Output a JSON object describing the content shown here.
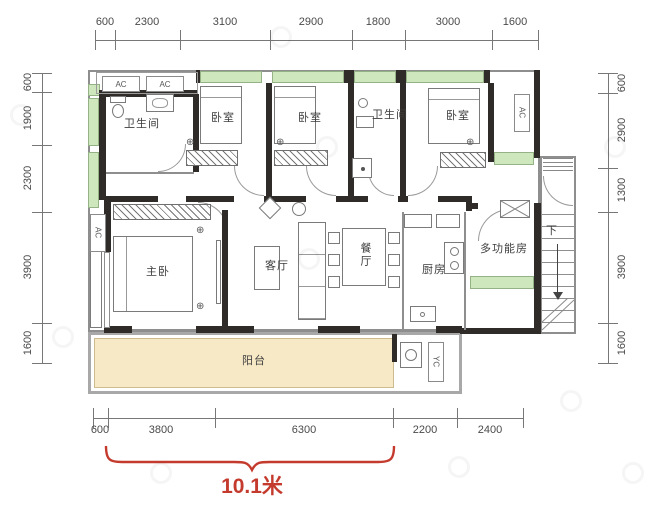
{
  "dims": {
    "top": [
      "600",
      "2300",
      "3100",
      "2900",
      "1800",
      "3000",
      "1600"
    ],
    "left": [
      "600",
      "1900",
      "2300",
      "3900",
      "1600"
    ],
    "right": [
      "600",
      "2900",
      "1300",
      "3900",
      "1600"
    ],
    "bottom": [
      "600",
      "3800",
      "6300",
      "2200",
      "2400"
    ]
  },
  "total_width": {
    "label": "10.1米"
  },
  "rooms": {
    "bathroom_1": {
      "label": "卫生间"
    },
    "bedroom_1": {
      "label": "卧室"
    },
    "bedroom_2": {
      "label": "卧室"
    },
    "bathroom_2": {
      "label": "卫生间"
    },
    "bedroom_3": {
      "label": "卧室"
    },
    "master_bedroom": {
      "label": "主卧"
    },
    "living_room": {
      "label": "客厅"
    },
    "dining_room": {
      "label": "餐厅"
    },
    "kitchen": {
      "label": "厨房"
    },
    "multi_function_room": {
      "label": "多功能房"
    },
    "balcony": {
      "label": "阳台"
    },
    "stairs": {
      "label": "下"
    }
  },
  "equipment": {
    "ac": "AC",
    "yc": "YC"
  },
  "colors": {
    "wall": "#2f2b28",
    "window": "#cfe7bd",
    "balcony_floor": "#f7e9c6",
    "dimension_text": "#4a4a4a",
    "highlight": "#c43b2e"
  }
}
